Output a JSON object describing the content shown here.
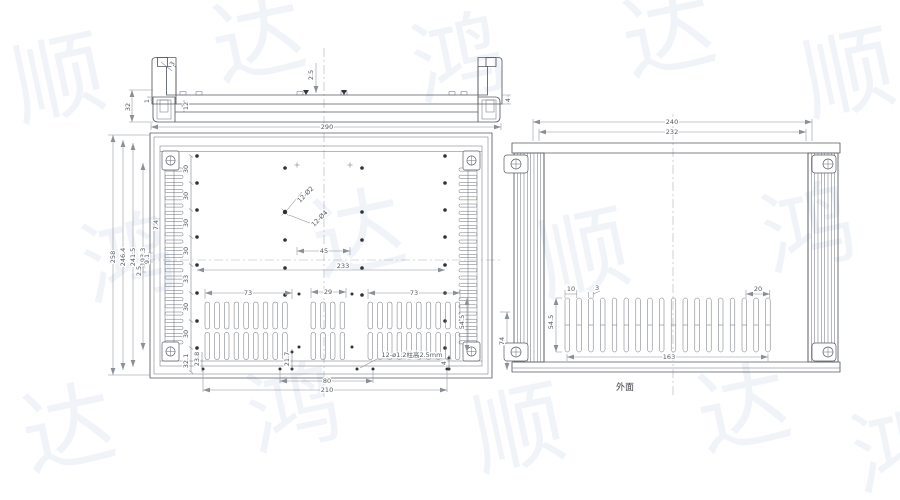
{
  "captions": {
    "outer_face": "外面"
  },
  "watermark": {
    "color": "#f0f3f8",
    "positions": [
      {
        "c": "顺",
        "x": 20,
        "y": 120
      },
      {
        "c": "达",
        "x": 220,
        "y": 80
      },
      {
        "c": "鸿",
        "x": 420,
        "y": 100
      },
      {
        "c": "达",
        "x": 630,
        "y": 75
      },
      {
        "c": "顺",
        "x": 810,
        "y": 115
      },
      {
        "c": "鸿",
        "x": 90,
        "y": 300
      },
      {
        "c": "达",
        "x": 320,
        "y": 275
      },
      {
        "c": "顺",
        "x": 545,
        "y": 295
      },
      {
        "c": "鸿",
        "x": 770,
        "y": 270
      },
      {
        "c": "达",
        "x": 30,
        "y": 470
      },
      {
        "c": "鸿",
        "x": 255,
        "y": 450
      },
      {
        "c": "顺",
        "x": 480,
        "y": 470
      },
      {
        "c": "达",
        "x": 705,
        "y": 450
      },
      {
        "c": "鸿",
        "x": 860,
        "y": 490
      }
    ]
  },
  "annotations": [
    {
      "id": "ts-3",
      "text": "3",
      "x": 174,
      "y": 65,
      "rot": -55
    },
    {
      "id": "ts-25",
      "text": "2.5",
      "x": 313,
      "y": 75,
      "rot": -90
    },
    {
      "id": "ts-4",
      "text": "4",
      "x": 510,
      "y": 100,
      "rot": -90
    },
    {
      "id": "ts-12",
      "text": "12",
      "x": 188,
      "y": 106,
      "rot": -90
    },
    {
      "id": "ts-1",
      "text": "1",
      "x": 149,
      "y": 101,
      "rot": -90
    },
    {
      "id": "ts-32",
      "text": "32",
      "x": 130,
      "y": 107,
      "rot": -90
    },
    {
      "id": "ts-290",
      "text": "290",
      "x": 327,
      "y": 129,
      "rot": 0
    },
    {
      "id": "lv-258",
      "text": "258",
      "x": 115,
      "y": 257,
      "rot": -90
    },
    {
      "id": "lv-2464",
      "text": "246.4",
      "x": 125,
      "y": 257,
      "rot": -90
    },
    {
      "id": "lv-2415",
      "text": "241.5",
      "x": 135,
      "y": 257,
      "rot": -90
    },
    {
      "id": "lv-1933",
      "text": "193.3",
      "x": 145,
      "y": 257,
      "rot": -90
    },
    {
      "id": "lv-74a",
      "text": "7.4",
      "x": 158,
      "y": 225,
      "rot": -90
    },
    {
      "id": "lv-91",
      "text": "9.1",
      "x": 149,
      "y": 259,
      "rot": -90
    },
    {
      "id": "lv-25",
      "text": "2.5",
      "x": 141,
      "y": 271,
      "rot": -90
    },
    {
      "id": "sp-1",
      "text": "30",
      "x": 188,
      "y": 169,
      "rot": -90
    },
    {
      "id": "sp-2",
      "text": "30",
      "x": 188,
      "y": 196,
      "rot": -90
    },
    {
      "id": "sp-3",
      "text": "30",
      "x": 188,
      "y": 223,
      "rot": -90
    },
    {
      "id": "sp-4",
      "text": "30",
      "x": 188,
      "y": 251,
      "rot": -90
    },
    {
      "id": "sp-5",
      "text": "33",
      "x": 188,
      "y": 279,
      "rot": -90
    },
    {
      "id": "sp-6",
      "text": "30",
      "x": 188,
      "y": 307,
      "rot": -90
    },
    {
      "id": "sp-7",
      "text": "30",
      "x": 188,
      "y": 334,
      "rot": -90
    },
    {
      "id": "lv-321",
      "text": "32.1",
      "x": 188,
      "y": 361,
      "rot": -90
    },
    {
      "id": "lv-238",
      "text": "23.8",
      "x": 199,
      "y": 359,
      "rot": -90
    },
    {
      "id": "lv-217",
      "text": "21.7",
      "x": 289,
      "y": 359,
      "rot": -90
    },
    {
      "id": "lv-12d2",
      "text": "12-Ø2",
      "x": 307,
      "y": 196,
      "rot": -45
    },
    {
      "id": "lv-12d4",
      "text": "12-Ø4",
      "x": 321,
      "y": 220,
      "rot": -45
    },
    {
      "id": "lv-45",
      "text": "45",
      "x": 324,
      "y": 253,
      "rot": 0
    },
    {
      "id": "lv-233",
      "text": "233",
      "x": 343,
      "y": 268,
      "rot": 0
    },
    {
      "id": "lv-73a",
      "text": "73",
      "x": 248,
      "y": 295,
      "rot": 0
    },
    {
      "id": "lv-29",
      "text": "29",
      "x": 328,
      "y": 294,
      "rot": 0
    },
    {
      "id": "lv-73b",
      "text": "73",
      "x": 414,
      "y": 295,
      "rot": 0
    },
    {
      "id": "lv-545",
      "text": "54.5",
      "x": 464,
      "y": 322,
      "rot": -90
    },
    {
      "id": "lv-4",
      "text": "4",
      "x": 446,
      "y": 363,
      "rot": -90
    },
    {
      "id": "lv-post",
      "text": "12-ø1.2柱高2.5mm",
      "x": 412,
      "y": 357,
      "rot": 0
    },
    {
      "id": "lv-80",
      "text": "80",
      "x": 327,
      "y": 383,
      "rot": 0
    },
    {
      "id": "lv-210",
      "text": "210",
      "x": 327,
      "y": 392,
      "rot": 0
    },
    {
      "id": "lv-74b",
      "text": "74",
      "x": 504,
      "y": 341,
      "rot": -90
    },
    {
      "id": "rv-240",
      "text": "240",
      "x": 672,
      "y": 124,
      "rot": 0
    },
    {
      "id": "rv-232",
      "text": "232",
      "x": 672,
      "y": 134,
      "rot": 0
    },
    {
      "id": "rv-10",
      "text": "10",
      "x": 571,
      "y": 291,
      "rot": 0
    },
    {
      "id": "rv-3",
      "text": "3",
      "x": 597,
      "y": 290,
      "rot": 0
    },
    {
      "id": "rv-20",
      "text": "20",
      "x": 758,
      "y": 291,
      "rot": 0
    },
    {
      "id": "rv-545",
      "text": "54.5",
      "x": 553,
      "y": 322,
      "rot": -90
    },
    {
      "id": "rv-163",
      "text": "163",
      "x": 669,
      "y": 359,
      "rot": 0
    }
  ],
  "geometry": {
    "hole_columns": [
      {
        "x": 197,
        "ys": [
          156,
          183,
          210,
          237,
          265,
          293,
          321,
          348
        ]
      },
      {
        "x": 445,
        "ys": [
          156,
          183,
          210,
          237,
          265,
          293,
          321,
          348
        ]
      }
    ],
    "center_hole_columns": [
      {
        "x": 285,
        "ys": [
          168,
          212,
          240,
          268,
          295
        ]
      },
      {
        "x": 362,
        "ys": [
          168,
          212,
          240,
          268,
          295
        ]
      }
    ],
    "crosses": [
      [
        297,
        165
      ],
      [
        350,
        165
      ]
    ],
    "star_hole": [
      285,
      212
    ],
    "extra_dots": [
      [
        299,
        294
      ],
      [
        352,
        294
      ],
      [
        299,
        347
      ],
      [
        352,
        347
      ],
      [
        292,
        352
      ],
      [
        292,
        369
      ],
      [
        280,
        369
      ],
      [
        373,
        369
      ],
      [
        203,
        369
      ],
      [
        447,
        369
      ],
      [
        357,
        369
      ],
      [
        449,
        358
      ],
      [
        449,
        369
      ]
    ],
    "comb_rails": [
      {
        "cx": 174,
        "y0": 168,
        "y1": 343,
        "step": 7.2,
        "w": 18
      },
      {
        "cx": 468,
        "y0": 168,
        "y1": 343,
        "step": 7.2,
        "w": 18
      }
    ],
    "slot_groups": [
      {
        "x0": 205,
        "cols": 9
      },
      {
        "x0": 311,
        "cols": 4
      },
      {
        "x0": 368,
        "cols": 10
      }
    ],
    "slot_rows_y": [
      302,
      332.5
    ],
    "slot_w": 4.6,
    "slot_h": 27,
    "slot_pitch": 9.7,
    "right_slots": {
      "x0": 565,
      "count": 18,
      "pitch": 11.8,
      "y": 298,
      "h": 54,
      "w": 4.6
    }
  }
}
